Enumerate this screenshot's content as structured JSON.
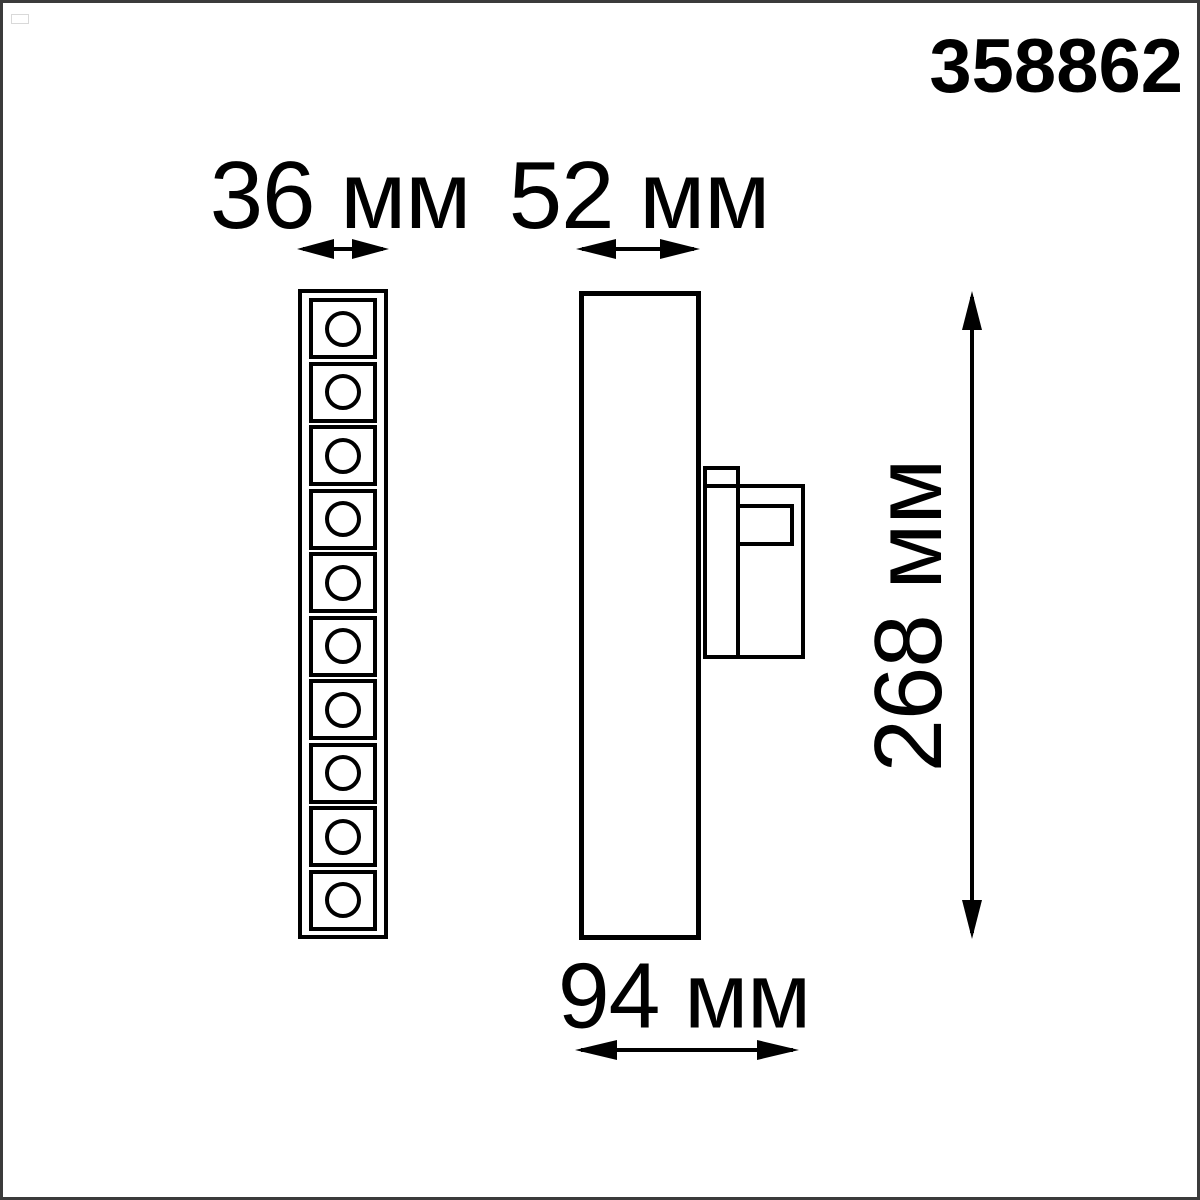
{
  "product": {
    "code": "358862"
  },
  "drawing": {
    "type": "technical-dimension-drawing",
    "unit": "мм",
    "dimensions": {
      "front_width": {
        "value": 36,
        "unit": "мм",
        "label": "36 мм"
      },
      "side_width": {
        "value": 52,
        "unit": "мм",
        "label": "52 мм"
      },
      "height": {
        "value": 268,
        "unit": "мм",
        "label": "268 мм"
      },
      "depth": {
        "value": 94,
        "unit": "мм",
        "label": "94 мм"
      }
    },
    "front_view": {
      "led_cells": 10
    },
    "colors": {
      "line": "#000000",
      "background": "#ffffff",
      "frame": "#3b3b3b"
    }
  }
}
